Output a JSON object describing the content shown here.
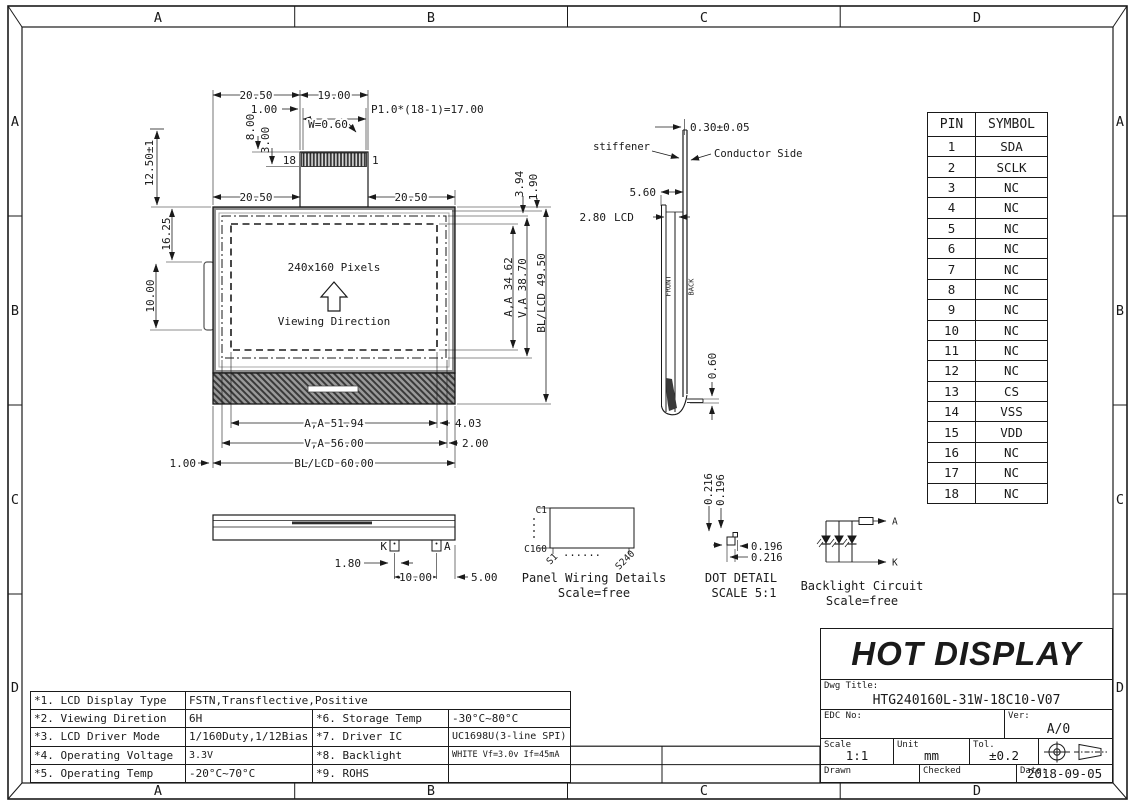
{
  "frame": {
    "zone_labels": [
      "A",
      "B",
      "C",
      "D"
    ]
  },
  "front_view": {
    "pixels_label": "240x160 Pixels",
    "viewing_direction": "Viewing Direction",
    "pin_left": "18",
    "pin_right": "1",
    "dims": {
      "d2050_top": "20.50",
      "d1900": "19.00",
      "d100_top": "1.00",
      "pitch": "P1.0*(18-1)=17.00",
      "w060": "W=0.60",
      "d800": "8.00",
      "d300": "3.00",
      "d1250": "12.50±1",
      "d2050_left": "20.50",
      "d2050_right": "20.50",
      "d1625": "16.25",
      "d1000_left": "10.00",
      "d394": "3.94",
      "d190": "1.90",
      "aa_v": "A,A 34.62",
      "va_v": "V,A 38.70",
      "bl_v": "BL/LCD 49.50",
      "aa_h": "A,A 51.94",
      "d403": "4.03",
      "va_h": "V,A 56.00",
      "d200": "2.00",
      "bl_h": "BL/LCD 60.00",
      "d100_bottom": "1.00"
    }
  },
  "side_view": {
    "stiffener": "stiffener",
    "conductor": "Conductor Side",
    "front": "FRONT",
    "back": "BACK",
    "dims": {
      "d030": "0.30±0.05",
      "d560": "5.60",
      "d280": "2.80",
      "lcd": "LCD",
      "d060": "0.60"
    }
  },
  "bottom_view": {
    "k": "K",
    "a": "A",
    "dims": {
      "d180": "1.80",
      "d1000": "10.00",
      "d500": "5.00"
    }
  },
  "panel_wiring": {
    "c1": "C1",
    "c160": "C160",
    "s1": "S1",
    "s240": "S240",
    "dots_h": "......",
    "title": "Panel Wiring Details",
    "scale": "Scale=free"
  },
  "dot_detail": {
    "dims": {
      "v1": "0.216",
      "v2": "0.196",
      "h1": "0.196",
      "h2": "0.216"
    },
    "title": "DOT DETAIL",
    "scale": "SCALE 5:1"
  },
  "backlight_circuit": {
    "a": "A",
    "k": "K",
    "title": "Backlight Circuit",
    "scale": "Scale=free"
  },
  "pin_table": {
    "headers": [
      "PIN",
      "SYMBOL"
    ],
    "rows": [
      {
        "pin": "1",
        "symbol": "SDA"
      },
      {
        "pin": "2",
        "symbol": "SCLK"
      },
      {
        "pin": "3",
        "symbol": "NC"
      },
      {
        "pin": "4",
        "symbol": "NC"
      },
      {
        "pin": "5",
        "symbol": "NC"
      },
      {
        "pin": "6",
        "symbol": "NC"
      },
      {
        "pin": "7",
        "symbol": "NC"
      },
      {
        "pin": "8",
        "symbol": "NC"
      },
      {
        "pin": "9",
        "symbol": "NC"
      },
      {
        "pin": "10",
        "symbol": "NC"
      },
      {
        "pin": "11",
        "symbol": "NC"
      },
      {
        "pin": "12",
        "symbol": "NC"
      },
      {
        "pin": "13",
        "symbol": "CS"
      },
      {
        "pin": "14",
        "symbol": "VSS"
      },
      {
        "pin": "15",
        "symbol": "VDD"
      },
      {
        "pin": "16",
        "symbol": "NC"
      },
      {
        "pin": "17",
        "symbol": "NC"
      },
      {
        "pin": "18",
        "symbol": "NC"
      }
    ]
  },
  "spec_table": {
    "rows": [
      {
        "label": "*1. LCD Display Type",
        "value": "FSTN,Transflective,Positive",
        "label2": "",
        "value2": ""
      },
      {
        "label": "*2. Viewing Diretion",
        "value": "6H",
        "label2": "*6. Storage Temp",
        "value2": "-30°C~80°C"
      },
      {
        "label": "*3. LCD Driver Mode",
        "value": "1/160Duty,1/12Bias",
        "label2": "*7. Driver IC",
        "value2": "UC1698U(3-line SPI)"
      },
      {
        "label": "*4. Operating Voltage",
        "value": "3.3V",
        "label2": "*8. Backlight",
        "value2": "WHITE Vf=3.0v If=45mA"
      },
      {
        "label": "*5. Operating Temp",
        "value": "-20°C~70°C",
        "label2": "*9. ROHS",
        "value2": ""
      }
    ]
  },
  "title_block": {
    "company": "HOT DISPLAY",
    "dwg_title_label": "Dwg Title:",
    "dwg_title": "HTG240160L-31W-18C10-V07",
    "edc_label": "EDC No:",
    "ver_label": "Ver:",
    "ver": "A/0",
    "scale_label": "Scale",
    "scale": "1:1",
    "unit_label": "Unit",
    "unit": "mm",
    "tol_label": "Tol.",
    "tol": "±0.2",
    "drawn_label": "Drawn",
    "checked_label": "Checked",
    "date_label": "Date:",
    "date": "2018-09-05"
  },
  "colors": {
    "line": "#1a1a1a",
    "hatch_dark": "#3a3a3a",
    "hatch_bg": "#9a9a9a"
  }
}
